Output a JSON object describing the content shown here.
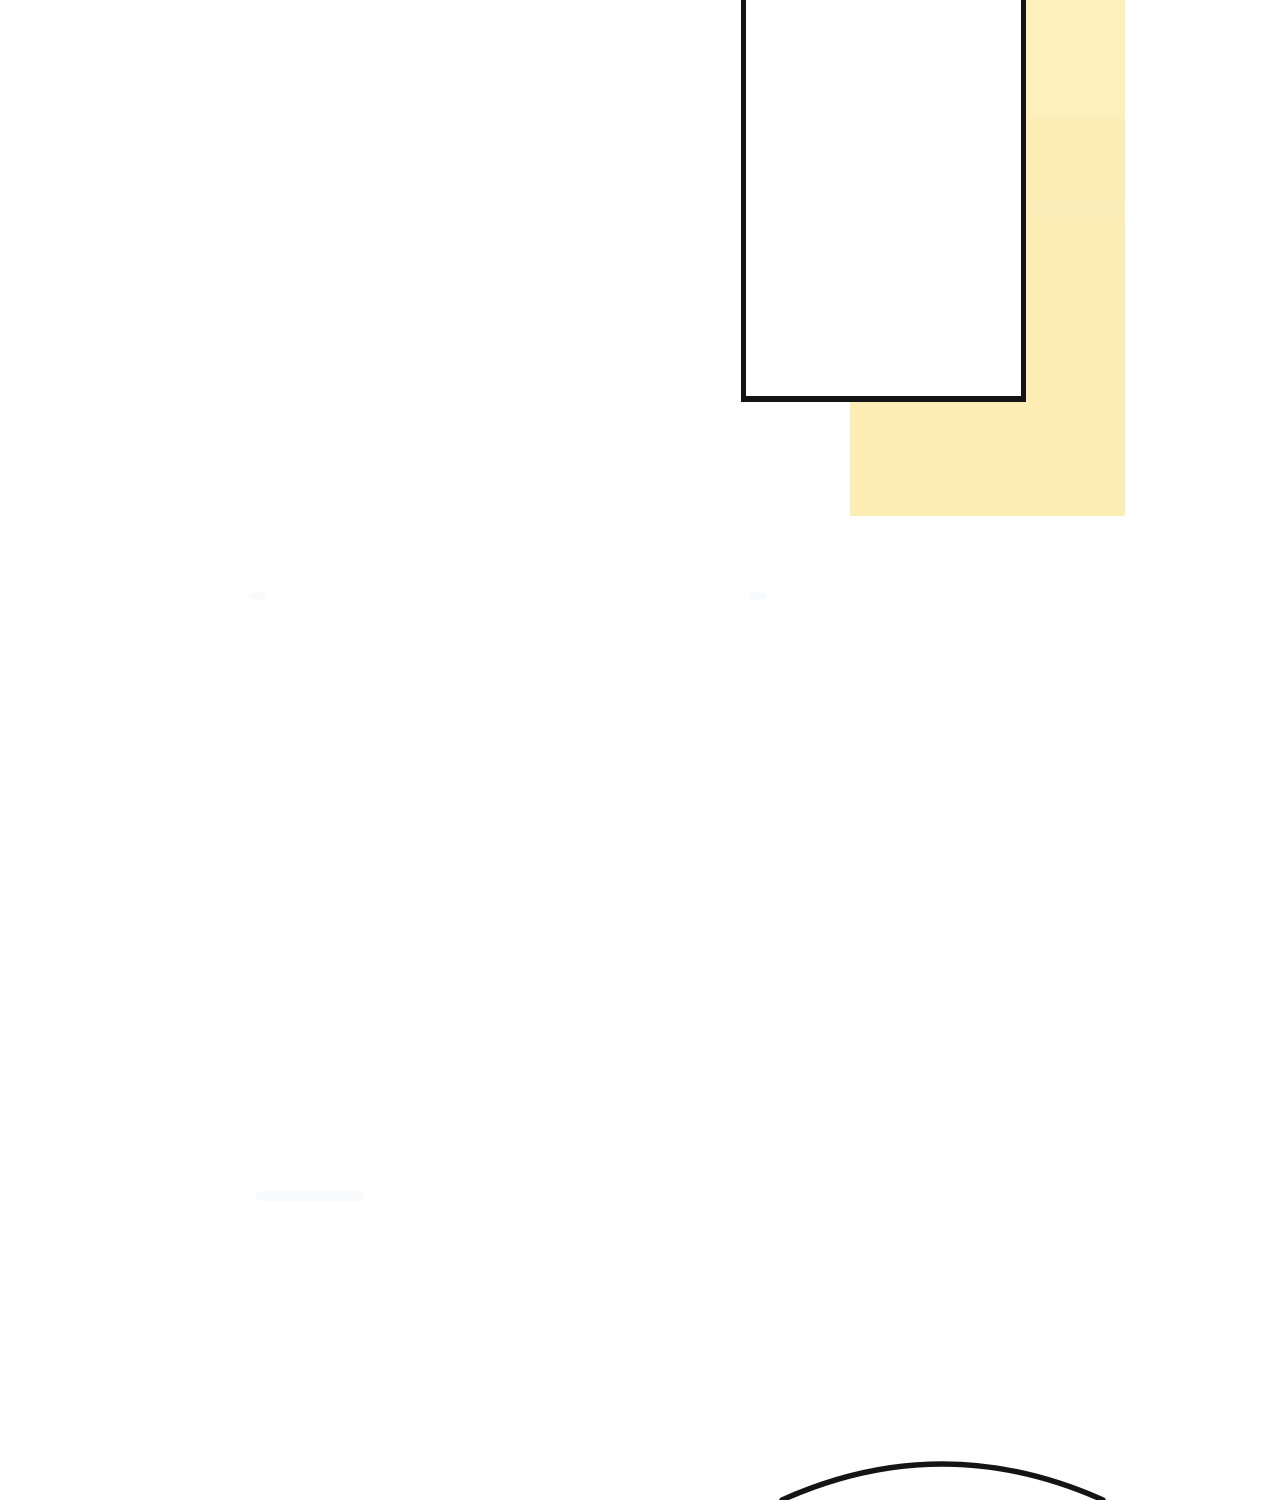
{
  "page": {
    "kind": "comic-strip-segment",
    "text_content": "none"
  },
  "colors": {
    "page-bg": "#ffffff",
    "ink": "#141414",
    "panel-fill": "#ffffff",
    "shadow-yellow": "#fcedb4",
    "shadow-yellow-light": "#fdf2c5",
    "smudge": "#f4f6f9"
  },
  "elements": {
    "comic_panel": "empty-white-panel-cropped-at-top",
    "panel_shadow": "pale-yellow-drop-shadow-offset-right-and-down",
    "head_arc": "top-outline-of-character-head-at-bottom-edge"
  }
}
